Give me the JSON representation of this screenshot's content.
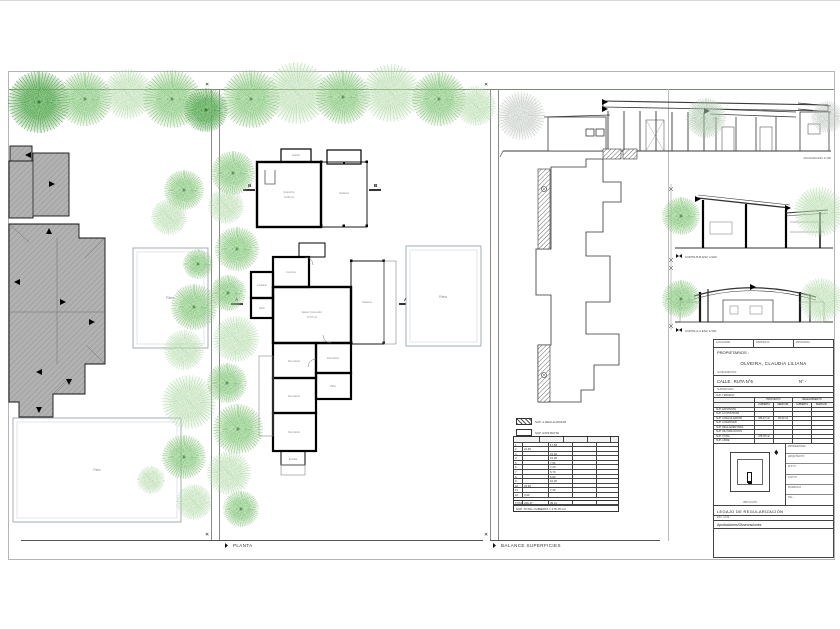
{
  "sheet_captions": {
    "planta": "PLANTA",
    "balance": "BALANCE SUPERFICIES"
  },
  "site_plan": {
    "pool_label": "Pileta",
    "patio_label": "Patio"
  },
  "floor_plan": {
    "pool_label": "Pileta",
    "section_a": "A",
    "section_b": "B",
    "rooms": {
      "asador": "Asador",
      "quincho": "Quincho",
      "quincho_area": "24,60 m2",
      "galeria_quincho": "Galería",
      "cocina": "Cocina",
      "lavadero": "Lavadero",
      "bano": "Baño",
      "estar": "Estar Comedor",
      "estar_area": "37,07 m2",
      "galeria": "Galería",
      "dormitorio": "Dormitorio",
      "entrada": "Entrada"
    }
  },
  "elevations": {
    "facade_caption": "FACHADA ESC 1/100",
    "corte_b_caption": "CORTE B-B ESC 1/100",
    "corte_a_caption": "CORTE A-A ESC 1/100"
  },
  "balance": {
    "legend": [
      {
        "label": "SUP. A REGULARIZAR"
      },
      {
        "label": "SUP. EXISTENTE"
      }
    ],
    "table": {
      "headers": [
        "N°",
        "SUP. CUBIERTA",
        "SUP. SEMICUB.",
        "SUP. DESCUB.",
        "SUP. TOTAL"
      ],
      "rows": [
        {
          "c0": "1",
          "c1": "",
          "c2": "17,50",
          "c3": "",
          "c4": ""
        },
        {
          "c0": "2",
          "c1": "24,60",
          "c2": "",
          "c3": "",
          "c4": ""
        },
        {
          "c0": "3",
          "c1": "",
          "c2": "21,40",
          "c3": "",
          "c4": ""
        },
        {
          "c0": "4",
          "c1": "",
          "c2": "15,90",
          "c3": "",
          "c4": ""
        },
        {
          "c0": "5",
          "c1": "",
          "c2": "7,60",
          "c3": "",
          "c4": ""
        },
        {
          "c0": "6",
          "c1": "",
          "c2": "7,20",
          "c3": "",
          "c4": ""
        },
        {
          "c0": "7",
          "c1": "",
          "c2": "5,70",
          "c3": "",
          "c4": ""
        },
        {
          "c0": "8",
          "c1": "",
          "c2": "6,80",
          "c3": "",
          "c4": ""
        },
        {
          "c0": "9",
          "c1": "",
          "c2": "10,30",
          "c3": "",
          "c4": ""
        },
        {
          "c0": "10",
          "c1": "23,60",
          "c2": "",
          "c3": "",
          "c4": ""
        },
        {
          "c0": "11",
          "c1": "",
          "c2": "7,40",
          "c3": "",
          "c4": ""
        },
        {
          "c0": "12",
          "c1": "4,90",
          "c2": "",
          "c3": "",
          "c4": ""
        }
      ],
      "total": [
        "TOTAL",
        "236,47",
        "39,31",
        "",
        ""
      ],
      "footer": "SUP. TOTAL CUBIERTA = 275,78 m2"
    }
  },
  "title_block": {
    "top_cells": [
      {
        "t": "LOCALIDAD"
      },
      {
        "t": "PARTIDA N°"
      },
      {
        "t": "PROVINCIA"
      }
    ],
    "owners_label": "PROPIETARIOS :",
    "owner_name": "OLVEIRA, CLAUDIA LILIANA",
    "antecedentes": "ANTECEDENTES",
    "address_label": "CALLE : RUTA N°6",
    "address_number": "N° -",
    "superficies_label": "SUPERFICIES",
    "terreno_label": "SUP. TERRENO",
    "col_groups": [
      {
        "t": "PROYECTO"
      },
      {
        "t": "RELEVAMIENTO"
      }
    ],
    "col_headers": [
      {
        "t": "CUBIERTA"
      },
      {
        "t": "SEMICUB."
      },
      {
        "t": "CUBIERTA"
      },
      {
        "t": "SEMICUB."
      }
    ],
    "rows": [
      {
        "label": "SUP. EXISTENTE",
        "v1": "",
        "v2": "",
        "v3": "",
        "v4": ""
      },
      {
        "label": "SUP. A CONSTRUIR",
        "v1": "",
        "v2": "",
        "v3": "",
        "v4": ""
      },
      {
        "label": "SUP. A REGULARIZAR",
        "v1": "236,47 m2",
        "v2": "39,31 m2",
        "v3": "",
        "v4": ""
      },
      {
        "label": "SUP. A DEMOLER",
        "v1": "",
        "v2": "",
        "v3": "",
        "v4": ""
      },
      {
        "label": "SUP. REGLAMENTARIA",
        "v1": "",
        "v2": "",
        "v3": "",
        "v4": ""
      },
      {
        "label": "SUP. DE INFRACCIÓN",
        "v1": "",
        "v2": "",
        "v3": "",
        "v4": ""
      },
      {
        "label": "SUP. TOTAL",
        "v1": "275,78 m2",
        "v2": "",
        "v3": "",
        "v4": ""
      },
      {
        "label": "SUP. LIBRE",
        "v1": "",
        "v2": "",
        "v3": "",
        "v4": ""
      }
    ],
    "ubicacion_caption": "UBICACIÓN",
    "north_icon": "♦",
    "professional_rows": [
      {
        "t": "PROFESIONAL :"
      },
      {
        "t": "ARQUITECTO"
      },
      {
        "t": "M.P. N°"
      },
      {
        "t": "CUIT N°"
      },
      {
        "t": "DOMICILIO :"
      },
      {
        "t": "TEL. :"
      }
    ],
    "legajo_label": "LEGAJO DE  REGULARIZACIÓN",
    "escala_label": "ESC. 1/100",
    "approvals_label": "Aprobaciones/Observaciones"
  }
}
